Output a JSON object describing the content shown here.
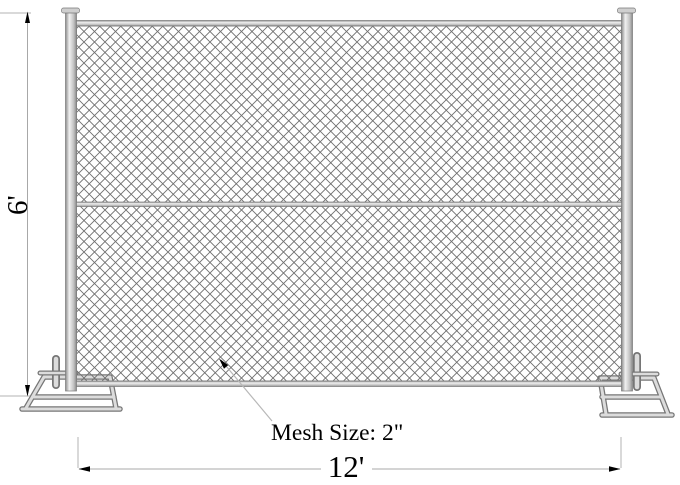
{
  "diagram": {
    "type": "temporary-chain-link-fence-panel",
    "labels": {
      "height": "6'",
      "width": "12'",
      "mesh": "Mesh Size: 2\""
    },
    "dimensions": {
      "panel_height_ft": "6",
      "panel_width_ft": "12",
      "mesh_size_in": "2"
    },
    "colors": {
      "background": "#ffffff",
      "tube_fill": "#dcdcdc",
      "tube_edge": "#767676",
      "mesh_line": "#6f6f6f",
      "dimension_line": "#a8a8a8",
      "arrow": "#000000",
      "text": "#000000"
    }
  }
}
